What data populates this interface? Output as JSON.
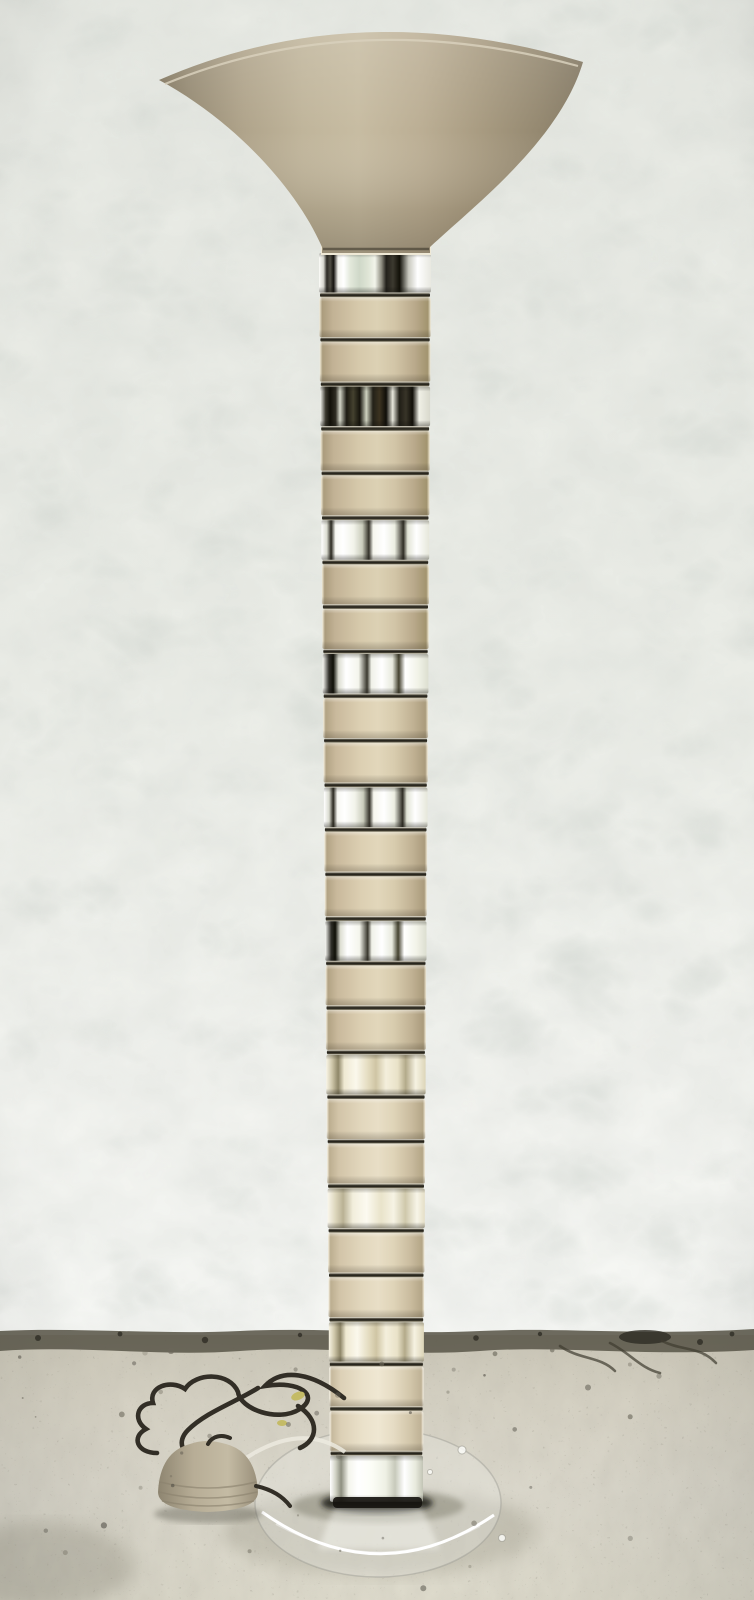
{
  "meta": {
    "description": "Product photograph of a vintage stacked lucite, chrome and taupe enamel torchiere floor lamp with flared trumpet shade, standing on a bare concrete floor against a white stucco wall; a dark tangled power cord with a beige dome foot switch lies on the floor to the left of the clear round lucite base.",
    "visible_text": "none"
  },
  "palette": {
    "wall_base": "#edefe9",
    "wall_bright": "#f8f9f6",
    "floor_base": "#d6d2c4",
    "floor_edge": "#bdb9a8",
    "junction": "#5e5b4e",
    "shade_mid": "#c7bca2",
    "shade_dark": "#827760",
    "tan_mid": "#e2d7bb",
    "tan_dark": "#a2946f",
    "chrome_white": "#ffffff",
    "chrome_dark": "#121008",
    "champagne": "#e9e2c8",
    "cord": "#322e26",
    "switch_body": "#b7ad96",
    "base_disc_highlight": "#ffffff",
    "foot_shadow": "#1c1a14"
  },
  "scene": {
    "wall_floor_junction_y": 1335,
    "floor_bottom_y": 1600
  },
  "lamp": {
    "shade": {
      "rim_left_x": 159,
      "rim_right_x": 583,
      "rim_top_y": 28,
      "neck_y": 247,
      "neck_width": 112
    },
    "column": {
      "x_top": 319,
      "w_top": 112,
      "x_bot": 330,
      "w_bot": 93,
      "y_top": 253,
      "slot_h": 44.55,
      "seg_h": 39.6,
      "bottom_seg_h": 46,
      "segments": [
        {
          "t": "chrome",
          "v": "cA"
        },
        {
          "t": "tan",
          "v": "t1"
        },
        {
          "t": "tan",
          "v": "t1"
        },
        {
          "t": "chrome",
          "v": "cDark"
        },
        {
          "t": "tan",
          "v": "t1"
        },
        {
          "t": "tan",
          "v": "t1"
        },
        {
          "t": "chrome",
          "v": "cB"
        },
        {
          "t": "tan",
          "v": "t1"
        },
        {
          "t": "tan",
          "v": "t1"
        },
        {
          "t": "chrome",
          "v": "cB2"
        },
        {
          "t": "tan",
          "v": "t2"
        },
        {
          "t": "tan",
          "v": "t2"
        },
        {
          "t": "chrome",
          "v": "cB"
        },
        {
          "t": "tan",
          "v": "t2"
        },
        {
          "t": "tan",
          "v": "t2"
        },
        {
          "t": "chrome",
          "v": "cB2"
        },
        {
          "t": "tan",
          "v": "t2"
        },
        {
          "t": "tan",
          "v": "t2"
        },
        {
          "t": "chrome",
          "v": "cCh"
        },
        {
          "t": "tan",
          "v": "t3"
        },
        {
          "t": "tan",
          "v": "t3"
        },
        {
          "t": "chrome",
          "v": "cCh2"
        },
        {
          "t": "tan",
          "v": "t3"
        },
        {
          "t": "tan",
          "v": "t3"
        },
        {
          "t": "chrome",
          "v": "cCh"
        },
        {
          "t": "tan",
          "v": "t4"
        },
        {
          "t": "tan",
          "v": "t4"
        },
        {
          "t": "chrome",
          "v": "cD"
        }
      ]
    },
    "base": {
      "cx": 378,
      "cy": 1503,
      "rx": 123,
      "ry": 74
    },
    "cord": {
      "switch_cx": 208,
      "switch_cy": 1478
    }
  }
}
